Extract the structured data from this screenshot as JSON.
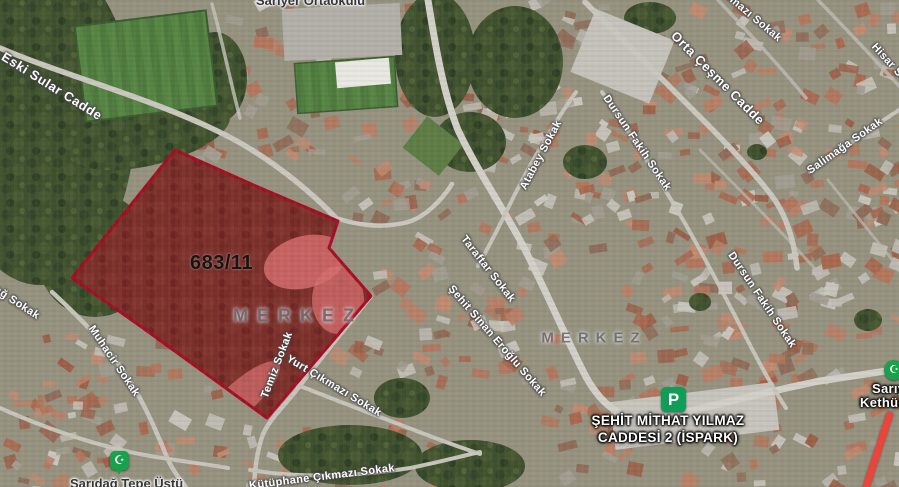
{
  "map": {
    "district_labels": [
      {
        "text": "MERKEZ"
      },
      {
        "text": "MERKEZ"
      }
    ],
    "street_labels": [
      {
        "text": "Eski Sular Cadde"
      },
      {
        "text": "ılmazı Sokak"
      },
      {
        "text": "Orta Çeşme Cadde"
      },
      {
        "text": "Hisar Sokak"
      },
      {
        "text": "Atabey Sokak"
      },
      {
        "text": "Dursun Fakih Sokak"
      },
      {
        "text": "Salimağa Sokak"
      },
      {
        "text": "Taraftar Sokak"
      },
      {
        "text": "Şehit Sinan Eroğlu Sokak"
      },
      {
        "text": "Dursun Fakih Sokak"
      },
      {
        "text": "Muhacir Sokak"
      },
      {
        "text": "dağ Sokak"
      },
      {
        "text": "Temiz Sokak"
      },
      {
        "text": "Yurt Çıkmazı Sokak"
      },
      {
        "text": "Kütüphane Çıkmazı Sokak"
      }
    ],
    "poi": {
      "school": "Sarıyer Ortaokulu",
      "saridag_tepe": "Sarıdağ Tepe Üstü",
      "kethuda_line1": "Sarıy",
      "kethuda_line2": "Kethüd"
    },
    "parking": {
      "icon_letter": "P",
      "line1": "ŞEHİT MİTHAT YILMAZ",
      "line2": "CADDESİ 2 (İSPARK)"
    },
    "parcel": {
      "id": "683/11",
      "outline_color": "#a50e22",
      "fill_color": "rgba(193,34,48,0.42)"
    },
    "icons": {
      "mosque_glyph": "☪",
      "mosque_marker_color": "#18a24b",
      "parking_marker_color": "#0f9d58",
      "route_stripe_color": "#e8453c"
    }
  }
}
